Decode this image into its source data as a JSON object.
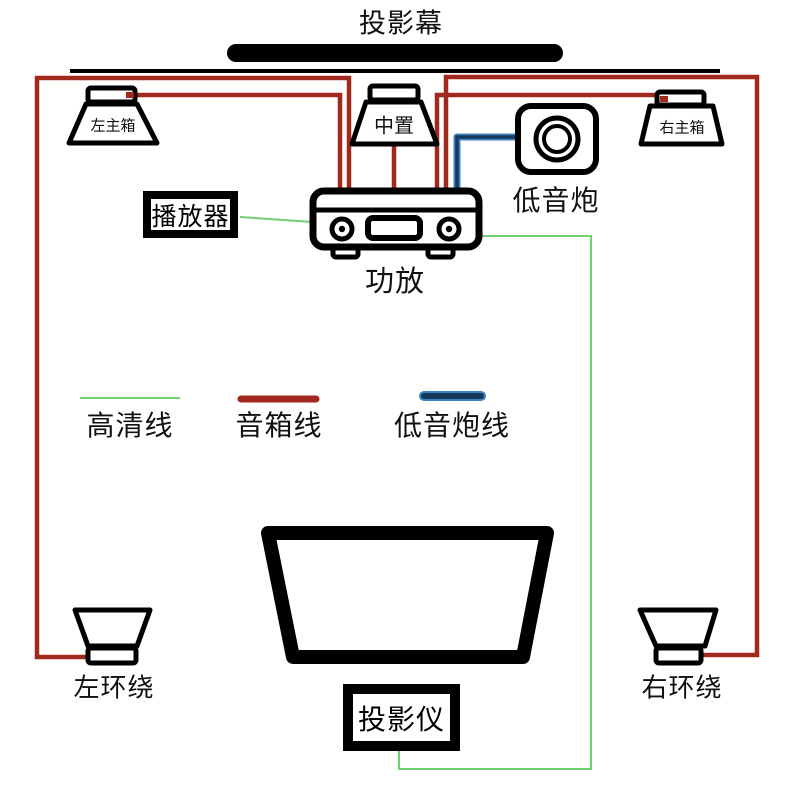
{
  "diagram": {
    "screen_label": "投影幕",
    "speakers": {
      "left_main": "左主箱",
      "center": "中置",
      "right_main": "右主箱",
      "left_surround": "左环绕",
      "right_surround": "右环绕"
    },
    "devices": {
      "subwoofer": "低音炮",
      "player": "播放器",
      "amplifier": "功放",
      "projector": "投影仪"
    },
    "legend": {
      "hdmi": "高清线",
      "speaker": "音箱线",
      "subwoofer": "低音炮线"
    },
    "colors": {
      "hdmi_wire": "#72d072",
      "speaker_wire": "#a1281c",
      "subwoofer_wire": "#163a5e",
      "subwoofer_wire_halo": "#3f82bd",
      "outline": "#000000"
    }
  }
}
